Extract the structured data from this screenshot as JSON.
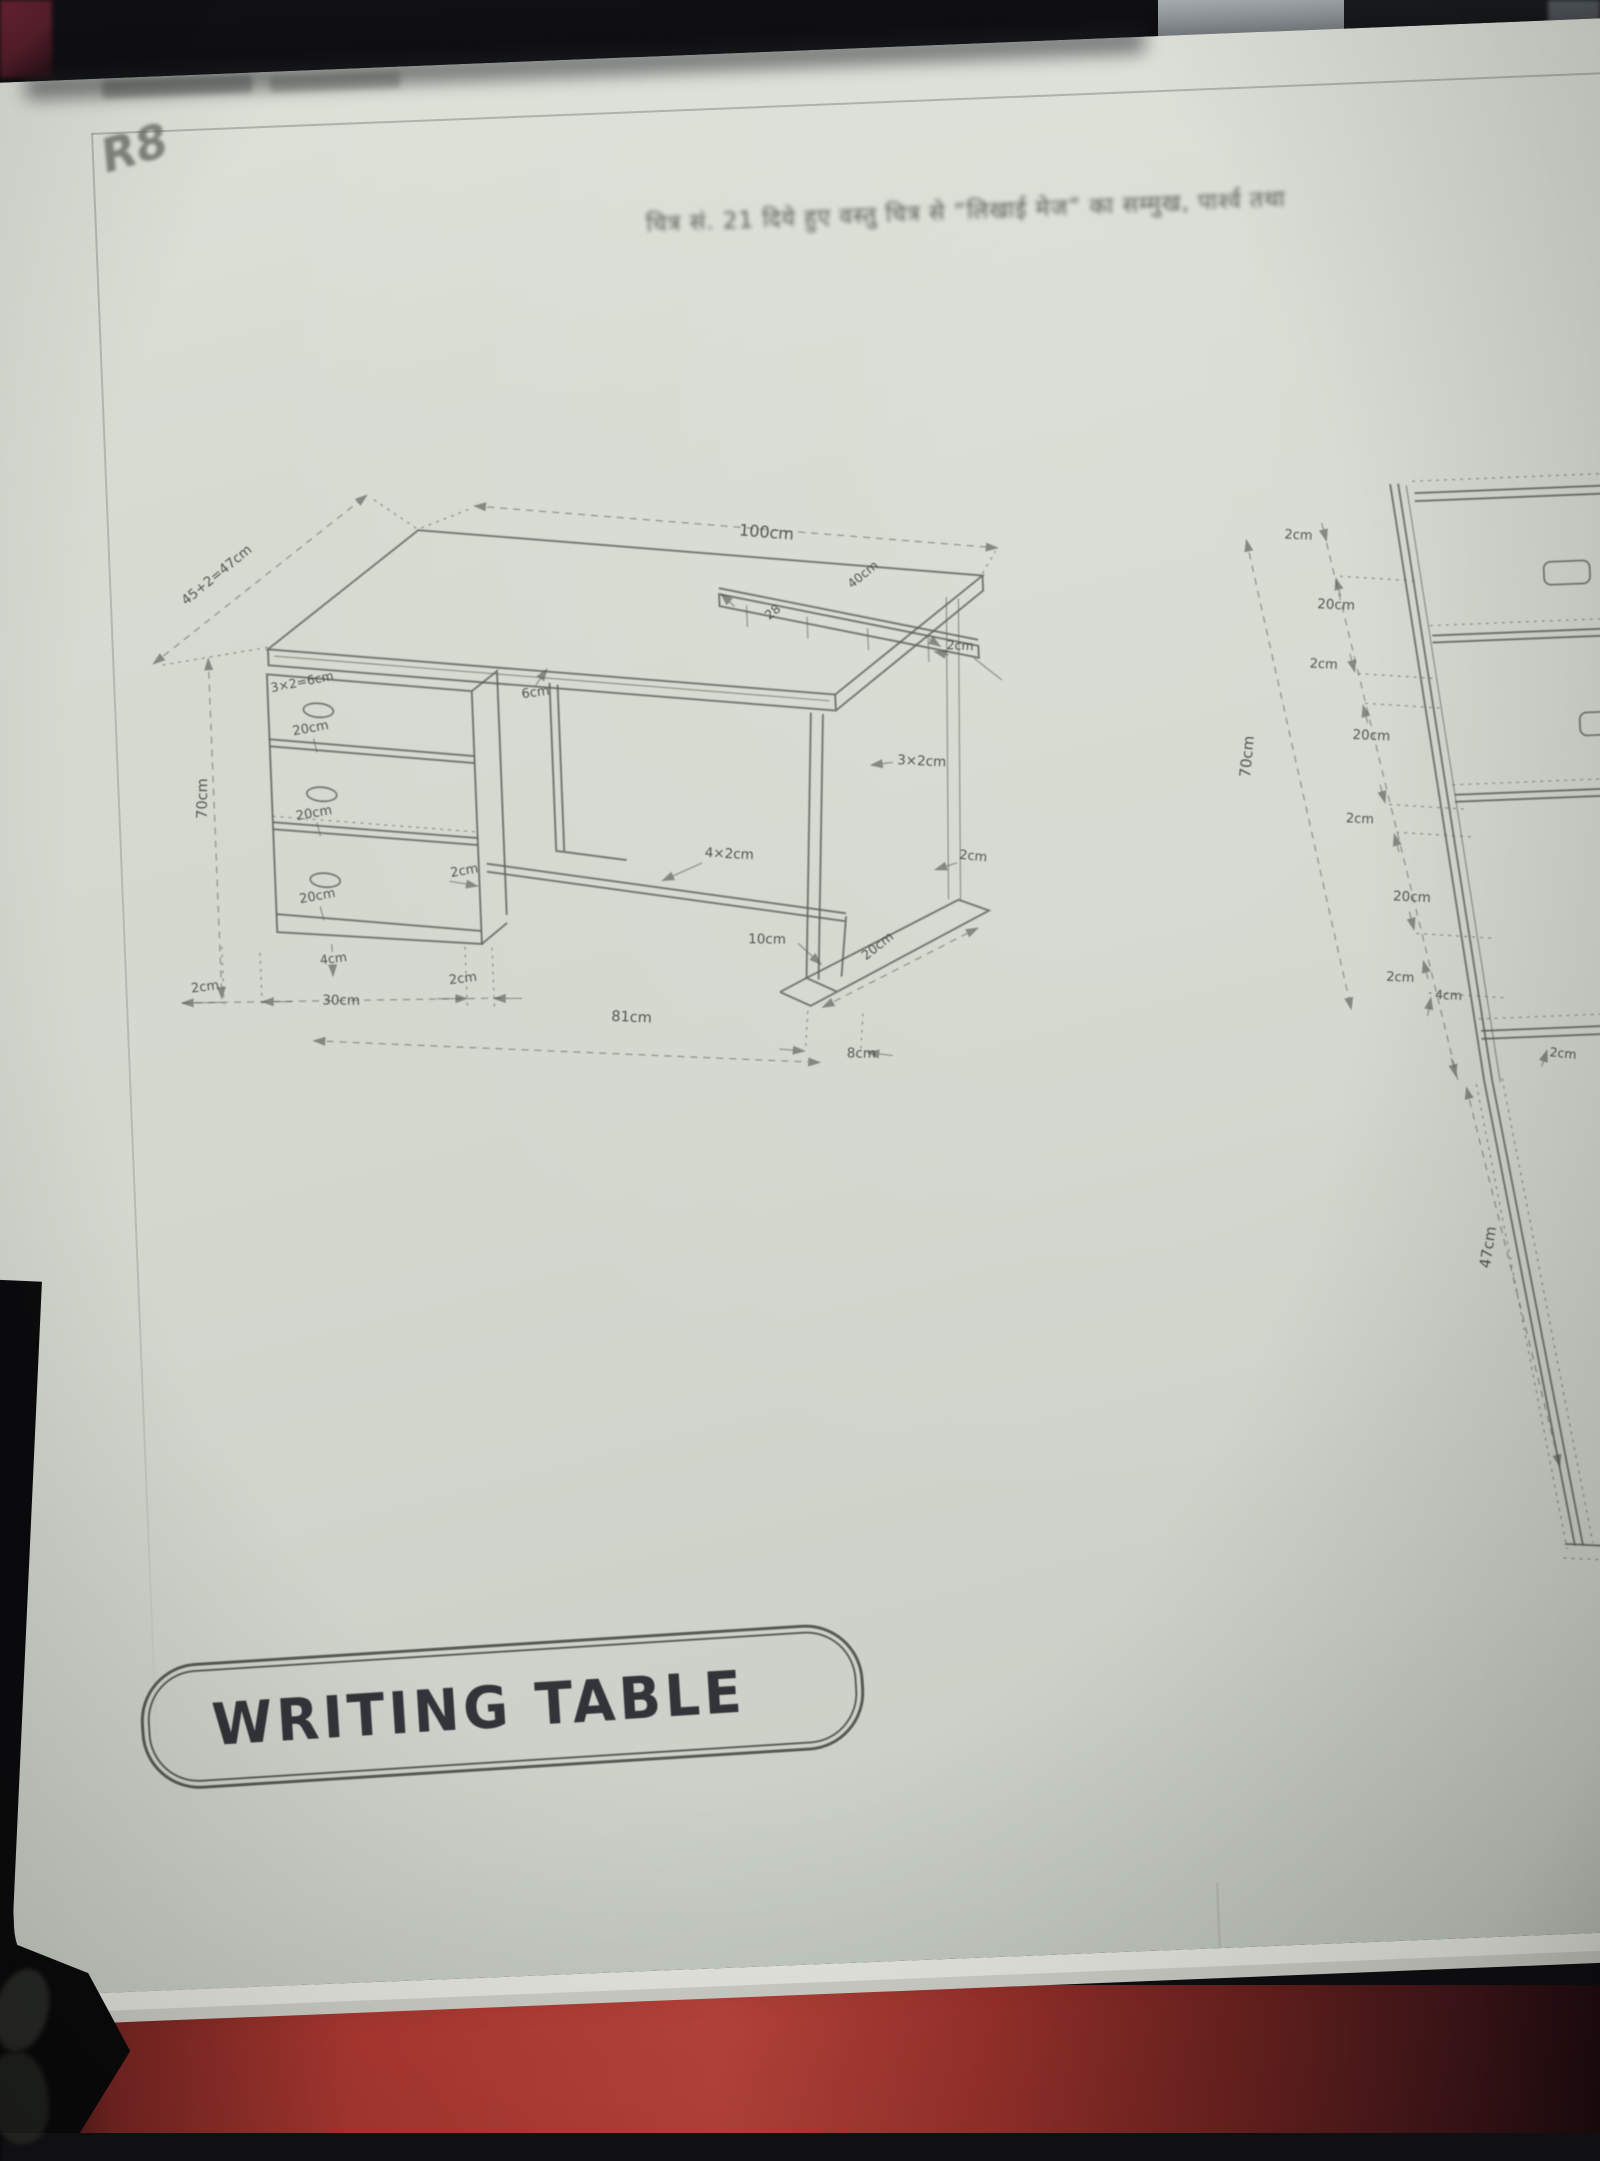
{
  "page": {
    "caption": "चित्र सं. 21 दिये हुए वस्तु चित्र से “लिखाई मेज” का सम्मुख, पार्श्व तथा",
    "handwritten_mark": "R8",
    "title_label": "WRITING TABLE"
  },
  "colors": {
    "page_bg": "#d5dad1",
    "line": "#5a5f57",
    "label_text": "#3e433c",
    "title_text": "#313539",
    "cover_red": "#b23a33",
    "top_object_gray": "#99a0a5"
  },
  "iso_view": {
    "name": "isometric writing table drawing",
    "labels": {
      "top_length": "100cm",
      "top_depth": "45+2=47cm",
      "height": "70cm",
      "pedestal_top": "3×2=6cm",
      "drawer1": "20cm",
      "drawer2": "20cm",
      "drawer3": "20cm",
      "pedestal_bottom_rail": "4cm",
      "base_left_thickness": "2cm",
      "pedestal_width": "30cm",
      "base_right_thickness": "2cm",
      "kneehole_width": "81cm",
      "apron": "6cm",
      "side_gap": "2cm",
      "stretcher": "4×2cm",
      "leg_section": "3×2cm",
      "leg_top_gap": "2cm",
      "foot_front": "10cm",
      "foot_length": "20cm",
      "foot_depth": "8cm",
      "shelf_end": "28",
      "shelf_length": "40cm",
      "shelf_thickness": "2cm"
    }
  },
  "side_view": {
    "name": "side elevation of pedestal",
    "labels": {
      "height": "70cm",
      "chain": [
        "2cm",
        "20cm",
        "2cm",
        "20cm",
        "2cm",
        "20cm",
        "2cm",
        "4cm"
      ],
      "top_thickness": "2cm",
      "leg_height": "47cm"
    }
  }
}
